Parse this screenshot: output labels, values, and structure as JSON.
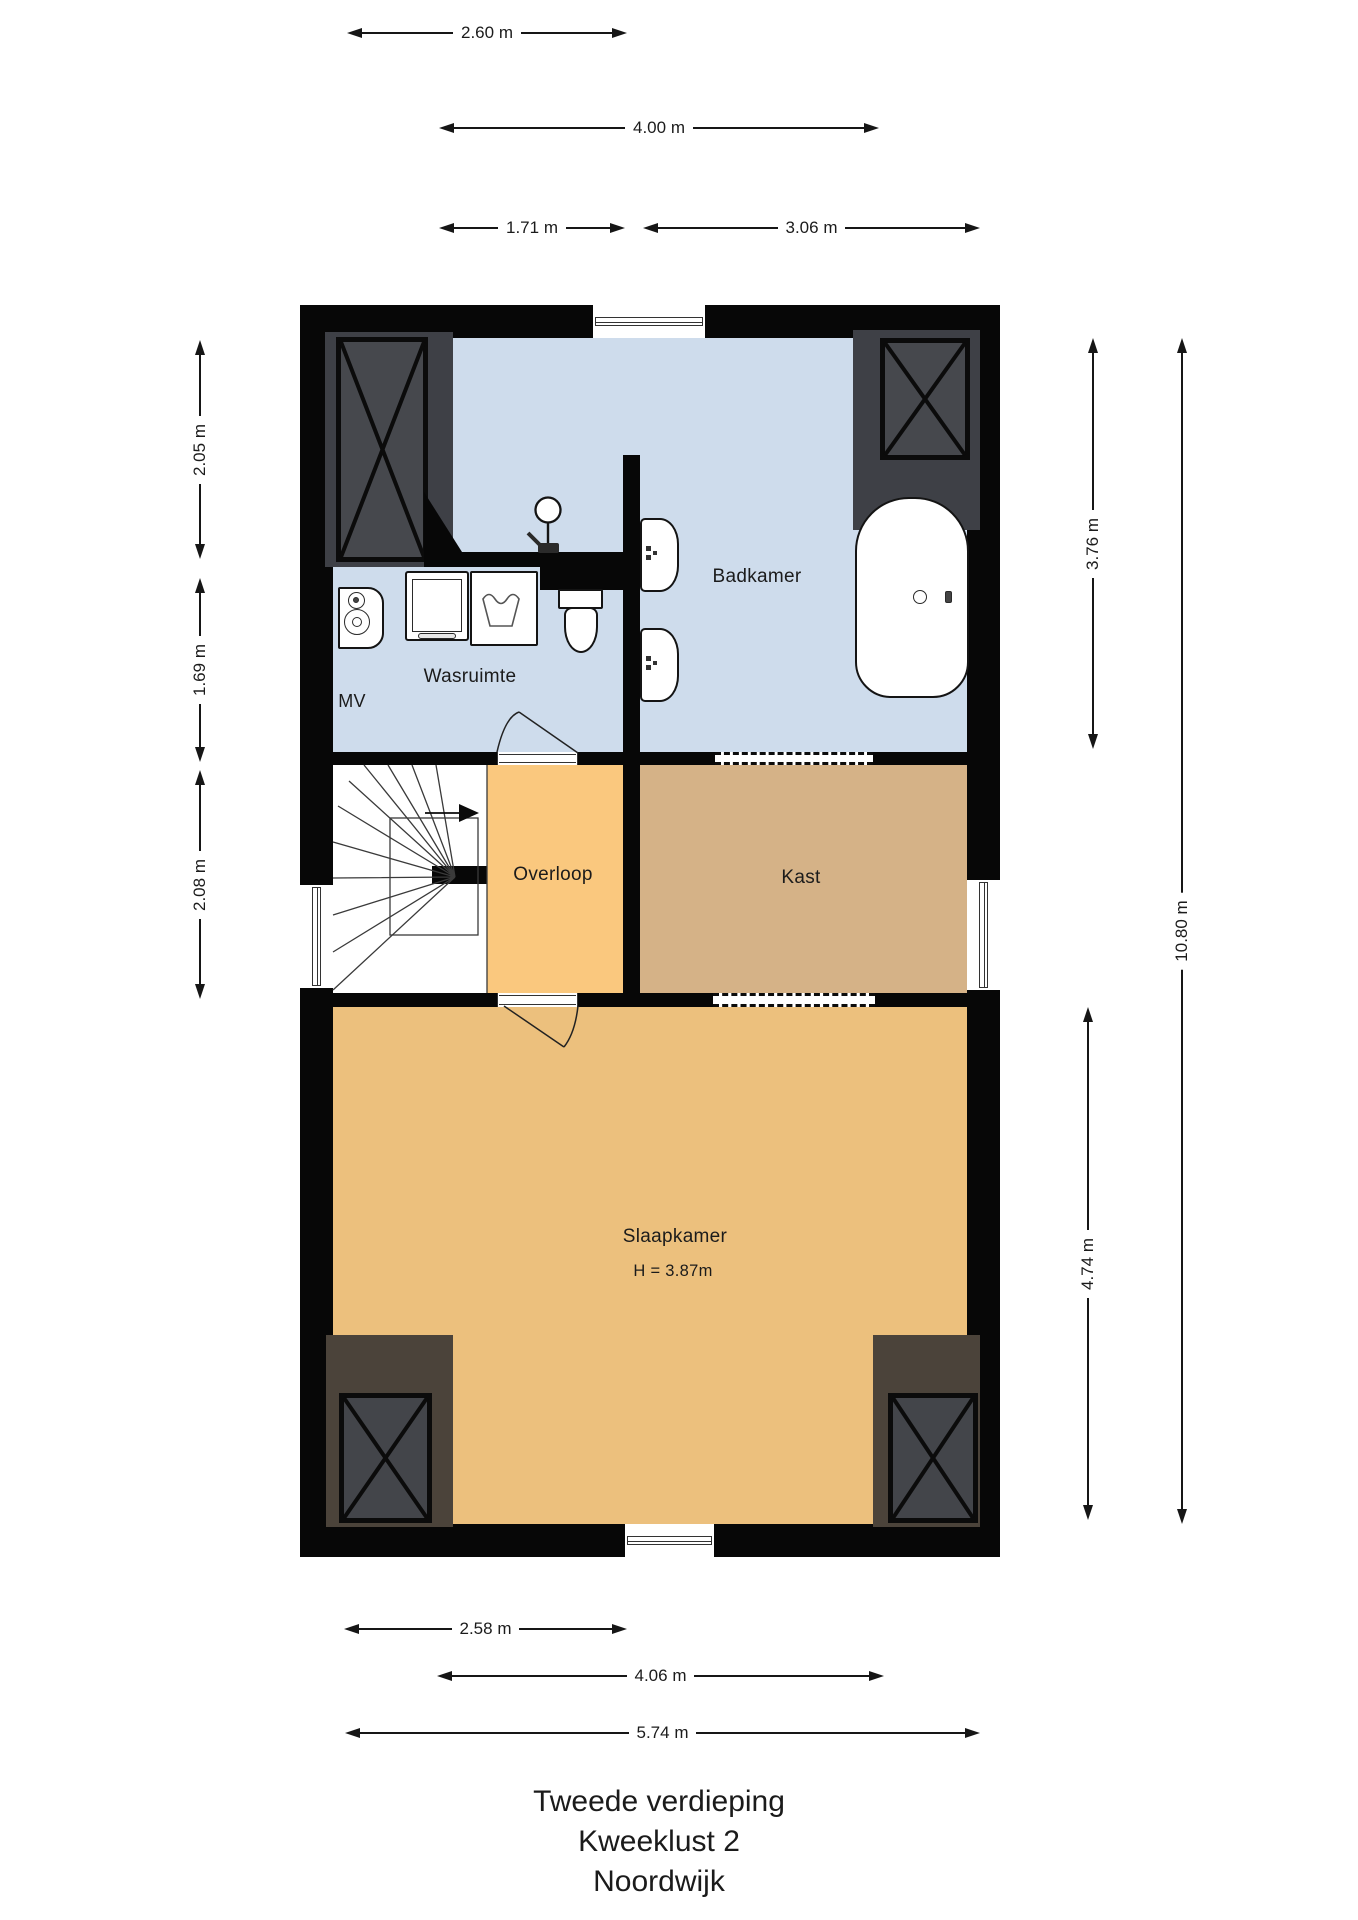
{
  "title": {
    "lines": [
      "Tweede verdieping",
      "Kweeklust 2",
      "Noordwijk"
    ]
  },
  "rooms": {
    "badkamer": {
      "label": "Badkamer"
    },
    "wasruimte": {
      "label": "Wasruimte"
    },
    "mv": {
      "label": "MV"
    },
    "overloop": {
      "label": "Overloop"
    },
    "kast": {
      "label": "Kast"
    },
    "slaapkamer": {
      "label": "Slaapkamer",
      "ceiling_height": "H = 3.87m"
    }
  },
  "dimensions": {
    "top": [
      {
        "label": "2.60 m"
      },
      {
        "label": "4.00 m"
      },
      {
        "label": "1.71 m"
      },
      {
        "label": "3.06 m"
      }
    ],
    "left": [
      {
        "label": "2.05 m"
      },
      {
        "label": "1.69 m"
      },
      {
        "label": "2.08 m"
      }
    ],
    "right": [
      {
        "label": "3.76 m"
      },
      {
        "label": "4.74 m"
      },
      {
        "label": "10.80 m"
      }
    ],
    "bottom": [
      {
        "label": "2.58 m"
      },
      {
        "label": "4.06 m"
      },
      {
        "label": "5.74 m"
      }
    ]
  },
  "colors": {
    "wall": "#070707",
    "bathroom_floor": "#cedcec",
    "landing_floor": "#fac87e",
    "closet_floor": "#d5b287",
    "bedroom_floor": "#ecc07d",
    "shaft_fill": "#3e4046",
    "shaft_panel": "#46484d",
    "chimney_fill": "#4b433a",
    "chimney_panel": "#43454a"
  },
  "fixtures": {
    "bathtub": "rounded-rect with drain and tap",
    "washbasin": "two basins on bathroom partition wall",
    "toilet": "tank and bowl",
    "shower": "shower head and mixer",
    "washing_machine": "square with drum",
    "laundry_sink": "square with wash symbol",
    "mv_unit": "mechanical ventilation box with fans",
    "staircase": "winder stairs with direction arrow"
  }
}
